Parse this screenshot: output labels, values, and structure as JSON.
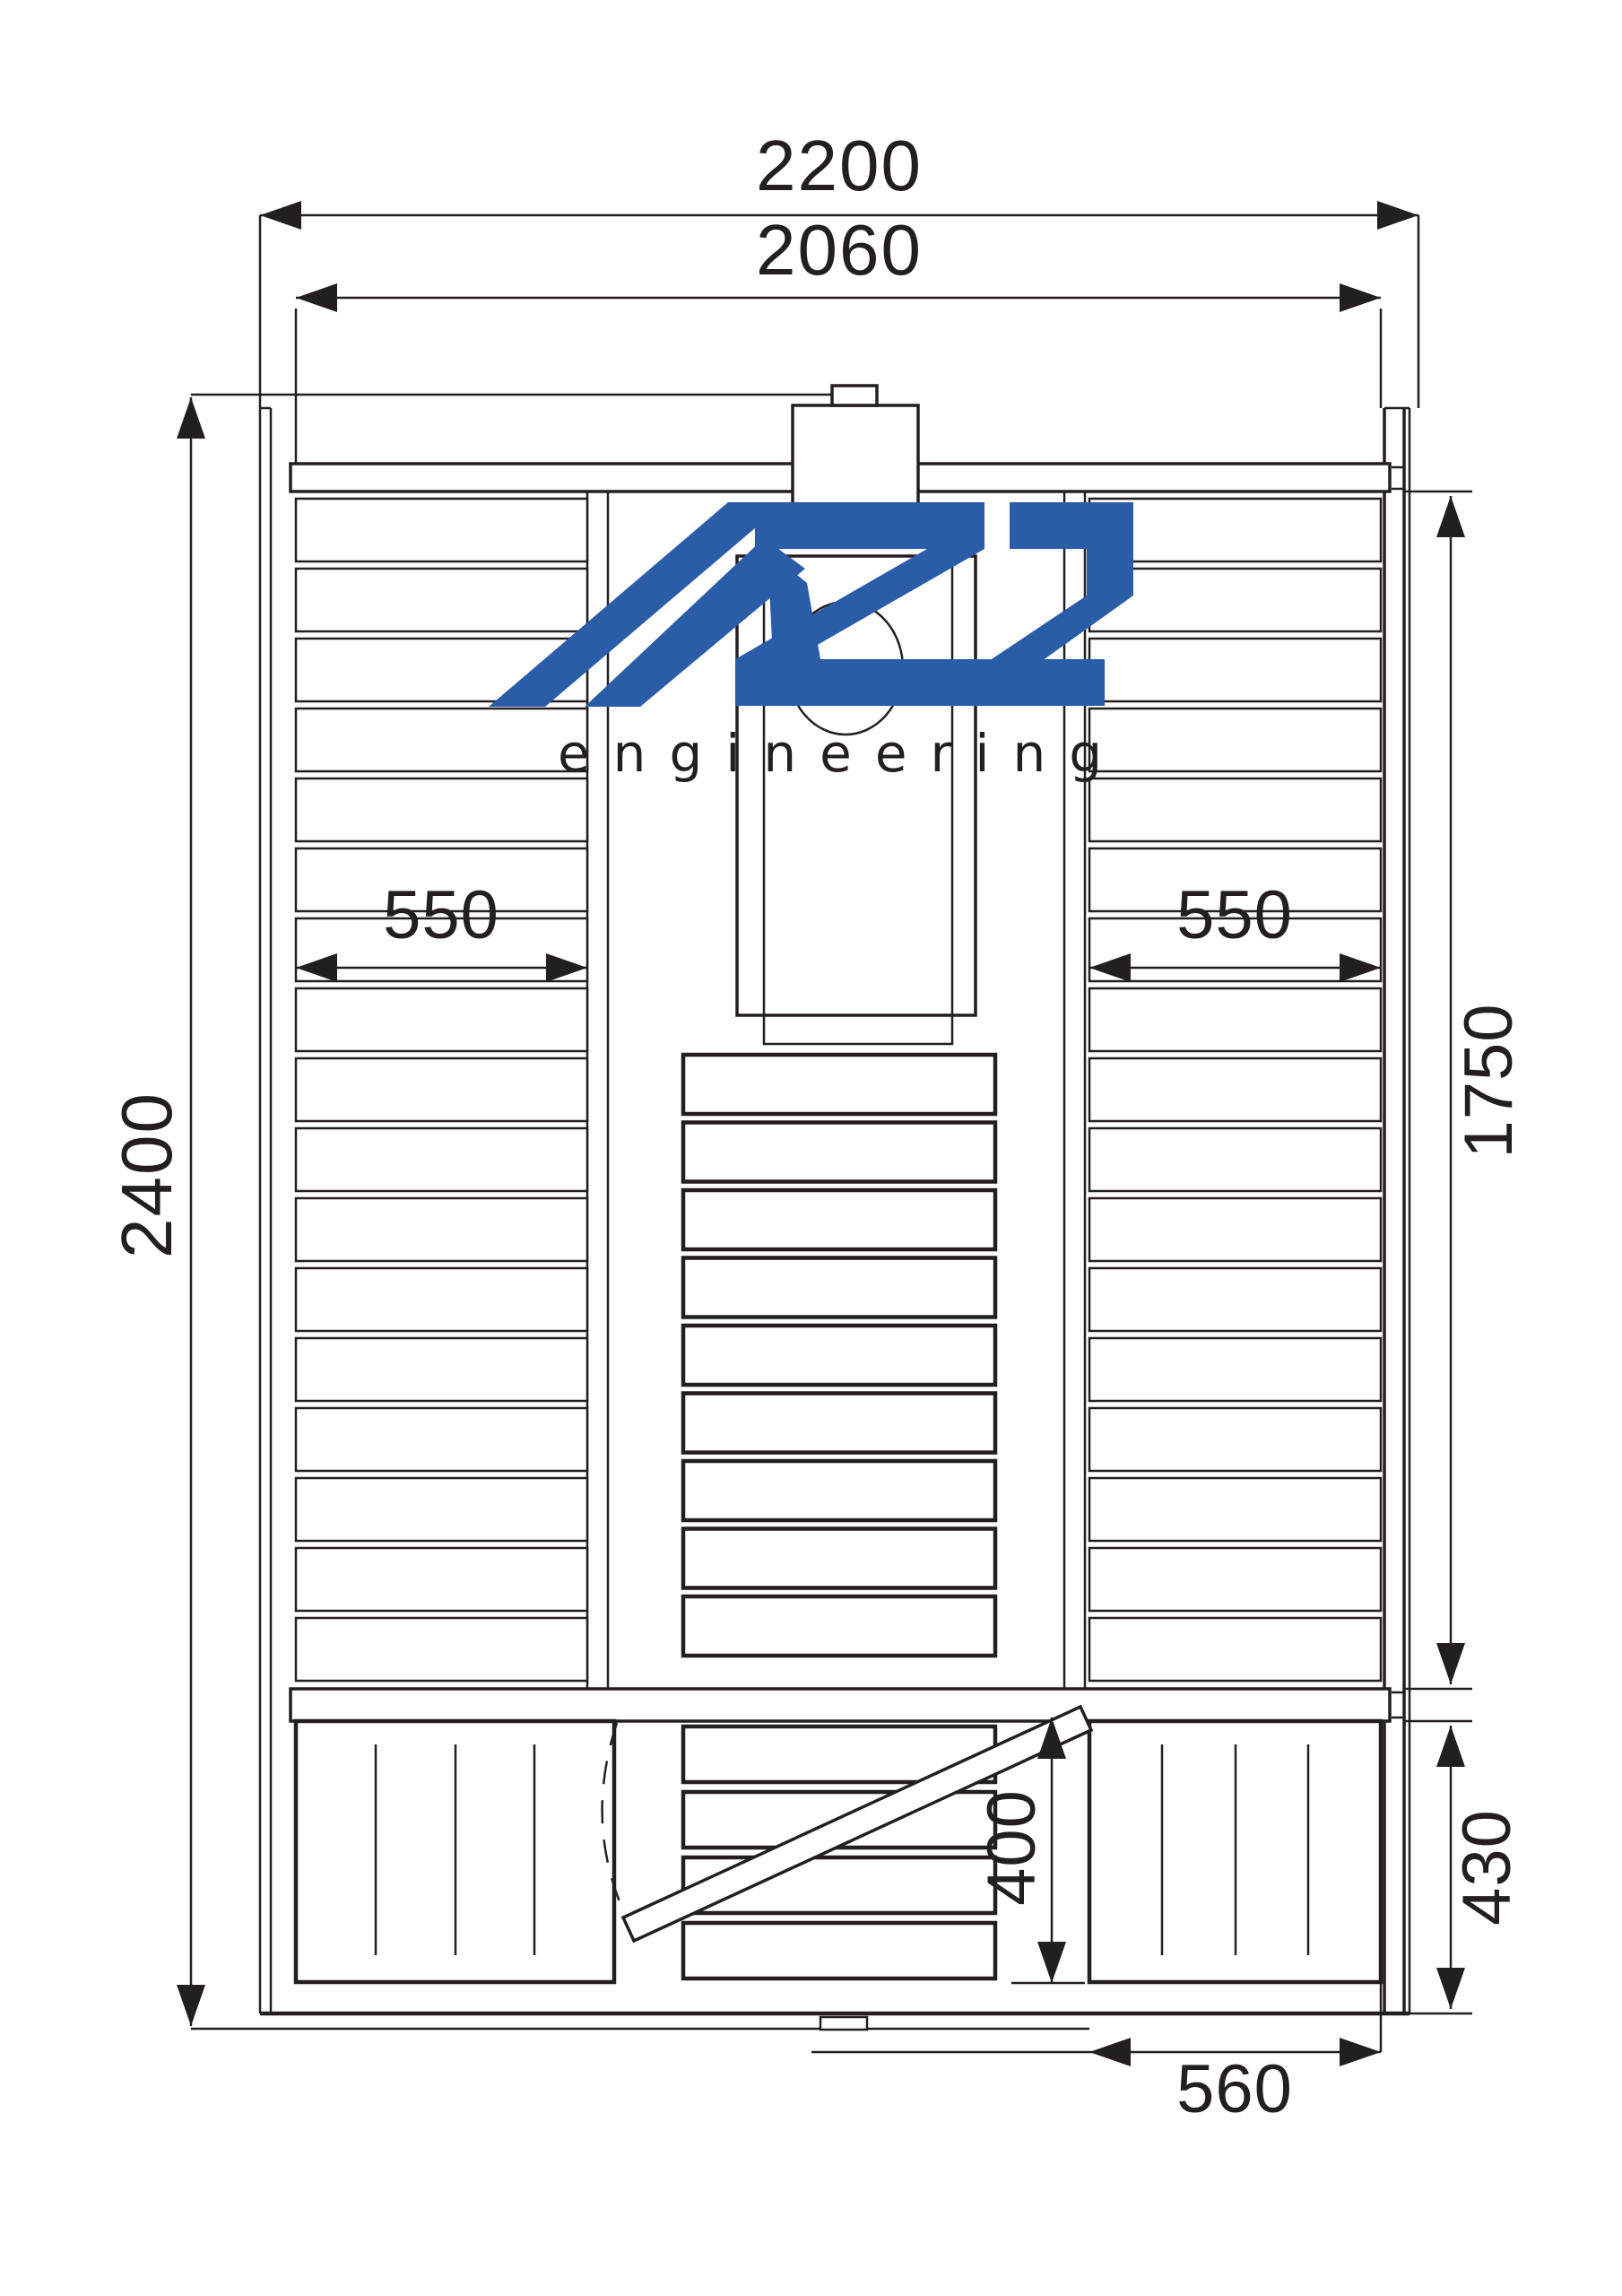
{
  "drawing": {
    "type": "technical-floor-plan-top-view",
    "subject": "sauna cabin layout with benches, stove and door swing",
    "units": "mm",
    "line_color": "#231f20",
    "background_color": "#ffffff",
    "dimensions": {
      "outer_width": "2200",
      "inner_width": "2060",
      "outer_depth": "2400",
      "left_bench_width": "550",
      "right_bench_width": "550",
      "main_room_depth": "1750",
      "lower_middle_bench_depth": "400",
      "entry_zone_depth": "430",
      "entry_bench_width": "560"
    },
    "logo": {
      "brand": "AZS",
      "subtitle": "engineering",
      "brand_color": "#2b5ca8",
      "subtitle_color": "#3b67b0"
    }
  }
}
